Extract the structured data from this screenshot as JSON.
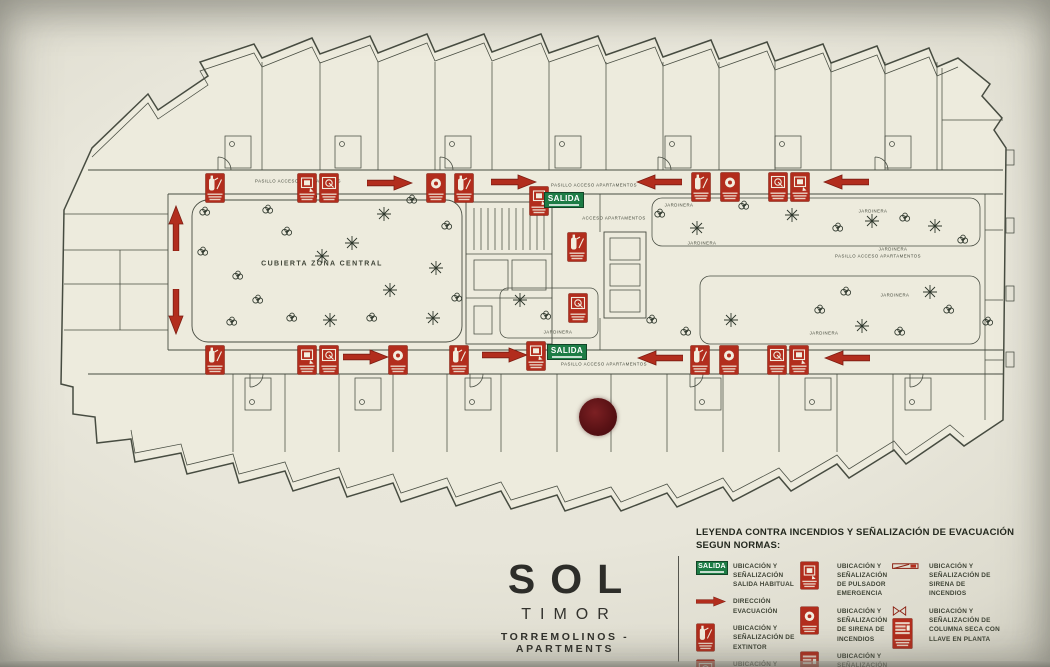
{
  "salida_text": "SALIDA",
  "title_block": {
    "brand": "SOL",
    "name": "TIMOR",
    "subtitle": "TORREMOLINOS - APARTMENTS"
  },
  "legend": {
    "title_line1": "LEYENDA CONTRA INCENDIOS Y SEÑALIZACIÓN DE EVACUACIÓN",
    "title_line2": "SEGUN NORMAS:",
    "columns": [
      {
        "items": [
          {
            "icon": "salida-sign",
            "label": "UBICACIÓN Y SEÑALIZACIÓN SALIDA HABITUAL"
          },
          {
            "icon": "evacuation-arrow",
            "label": "DIRECCIÓN EVACUACIÓN"
          },
          {
            "icon": "extintor",
            "label": "UBICACIÓN Y SEÑALIZACIÓN DE EXTINTOR"
          },
          {
            "icon": "boca-incendio",
            "label": "UBICACIÓN Y SEÑALIZACIÓN DE BOCA DE INCENDIO"
          }
        ]
      },
      {
        "items": [
          {
            "icon": "pulsador",
            "label": "UBICACIÓN Y SEÑALIZACIÓN DE PULSADOR EMERGENCIA"
          },
          {
            "icon": "sirena",
            "label": "UBICACIÓN Y SEÑALIZACIÓN DE SIRENA DE INCENDIOS"
          },
          {
            "icon": "columna-seca",
            "label": "UBICACIÓN Y SEÑALIZACIÓN DE COLUMNA SECA"
          }
        ]
      },
      {
        "items": [
          {
            "icon": "sirena-techo",
            "label": "UBICACIÓN Y SEÑALIZACIÓN DE SIRENA DE INCENDIOS"
          },
          {
            "icon": "columna-seca-llave",
            "label": "UBICACIÓN Y SEÑALIZACIÓN DE COLUMNA SECA CON LLAVE EN PLANTA"
          }
        ]
      }
    ]
  },
  "plan": {
    "labels": [
      {
        "text": "CUBIERTA ZONA CENTRAL",
        "x": 322,
        "y": 264,
        "size": 7
      },
      {
        "text": "PASILLO ACCESO APARTAMENTOS",
        "x": 298,
        "y": 181,
        "size": 4.3
      },
      {
        "text": "PASILLO ACCESO APARTAMENTOS",
        "x": 594,
        "y": 185,
        "size": 4.3
      },
      {
        "text": "PASILLO ACCESO APARTAMENTOS",
        "x": 878,
        "y": 256,
        "size": 4.3
      },
      {
        "text": "PASILLO ACCESO APARTAMENTOS",
        "x": 604,
        "y": 364,
        "size": 4.3
      },
      {
        "text": "ACCESO APARTAMENTOS",
        "x": 614,
        "y": 218,
        "size": 4.3
      },
      {
        "text": "JARDINERA",
        "x": 679,
        "y": 205,
        "size": 4.3
      },
      {
        "text": "JARDINERA",
        "x": 702,
        "y": 243,
        "size": 4.3
      },
      {
        "text": "JARDINERA",
        "x": 873,
        "y": 211,
        "size": 4.3
      },
      {
        "text": "JARDINERA",
        "x": 893,
        "y": 249,
        "size": 4.3
      },
      {
        "text": "JARDINERA",
        "x": 895,
        "y": 295,
        "size": 4.3
      },
      {
        "text": "JARDINERA",
        "x": 824,
        "y": 333,
        "size": 4.3
      },
      {
        "text": "JARDINERA",
        "x": 558,
        "y": 332,
        "size": 4.3
      }
    ],
    "markers": [
      {
        "type": "extintor",
        "x": 215,
        "y": 188
      },
      {
        "type": "pulsador",
        "x": 307,
        "y": 188
      },
      {
        "type": "boca-incendio",
        "x": 329,
        "y": 188
      },
      {
        "type": "arrow",
        "x": 390,
        "y": 183,
        "dir": "right"
      },
      {
        "type": "sirena",
        "x": 436,
        "y": 188
      },
      {
        "type": "extintor",
        "x": 464,
        "y": 188
      },
      {
        "type": "arrow",
        "x": 514,
        "y": 182,
        "dir": "right"
      },
      {
        "type": "pulsador",
        "x": 539,
        "y": 201
      },
      {
        "type": "salida-sign",
        "x": 564,
        "y": 200
      },
      {
        "type": "arrow",
        "x": 659,
        "y": 182,
        "dir": "left"
      },
      {
        "type": "extintor",
        "x": 701,
        "y": 187
      },
      {
        "type": "sirena",
        "x": 730,
        "y": 187
      },
      {
        "type": "boca-incendio",
        "x": 778,
        "y": 187
      },
      {
        "type": "pulsador",
        "x": 800,
        "y": 187
      },
      {
        "type": "arrow",
        "x": 846,
        "y": 182,
        "dir": "left"
      },
      {
        "type": "arrow",
        "x": 176,
        "y": 228,
        "dir": "up"
      },
      {
        "type": "arrow",
        "x": 176,
        "y": 312,
        "dir": "down"
      },
      {
        "type": "extintor",
        "x": 577,
        "y": 247
      },
      {
        "type": "boca-incendio",
        "x": 578,
        "y": 308
      },
      {
        "type": "extintor",
        "x": 215,
        "y": 360
      },
      {
        "type": "pulsador",
        "x": 307,
        "y": 360
      },
      {
        "type": "boca-incendio",
        "x": 329,
        "y": 360
      },
      {
        "type": "arrow",
        "x": 366,
        "y": 357,
        "dir": "right"
      },
      {
        "type": "sirena",
        "x": 398,
        "y": 360
      },
      {
        "type": "extintor",
        "x": 459,
        "y": 360
      },
      {
        "type": "arrow",
        "x": 505,
        "y": 355,
        "dir": "right"
      },
      {
        "type": "pulsador",
        "x": 536,
        "y": 356
      },
      {
        "type": "salida-sign",
        "x": 567,
        "y": 352
      },
      {
        "type": "arrow",
        "x": 660,
        "y": 358,
        "dir": "left"
      },
      {
        "type": "extintor",
        "x": 700,
        "y": 360
      },
      {
        "type": "sirena",
        "x": 729,
        "y": 360
      },
      {
        "type": "boca-incendio",
        "x": 777,
        "y": 360
      },
      {
        "type": "pulsador",
        "x": 799,
        "y": 360
      },
      {
        "type": "arrow",
        "x": 847,
        "y": 358,
        "dir": "left"
      }
    ],
    "plants": [
      [
        205,
        212,
        "b"
      ],
      [
        268,
        210,
        "b"
      ],
      [
        312,
        196,
        "b"
      ],
      [
        412,
        200,
        "b"
      ],
      [
        203,
        252,
        "b"
      ],
      [
        287,
        232,
        "b"
      ],
      [
        352,
        243,
        "p"
      ],
      [
        384,
        214,
        "p"
      ],
      [
        322,
        256,
        "p"
      ],
      [
        436,
        268,
        "p"
      ],
      [
        447,
        226,
        "b"
      ],
      [
        238,
        276,
        "b"
      ],
      [
        258,
        300,
        "b"
      ],
      [
        292,
        318,
        "b"
      ],
      [
        232,
        322,
        "b"
      ],
      [
        330,
        320,
        "p"
      ],
      [
        372,
        318,
        "b"
      ],
      [
        433,
        318,
        "p"
      ],
      [
        457,
        298,
        "b"
      ],
      [
        390,
        290,
        "p"
      ],
      [
        660,
        214,
        "b"
      ],
      [
        697,
        228,
        "p"
      ],
      [
        744,
        206,
        "b"
      ],
      [
        792,
        215,
        "p"
      ],
      [
        838,
        228,
        "b"
      ],
      [
        872,
        221,
        "p"
      ],
      [
        905,
        218,
        "b"
      ],
      [
        935,
        226,
        "p"
      ],
      [
        963,
        240,
        "b"
      ],
      [
        520,
        300,
        "p"
      ],
      [
        546,
        316,
        "b"
      ],
      [
        578,
        300,
        "b"
      ],
      [
        652,
        320,
        "b"
      ],
      [
        686,
        332,
        "b"
      ],
      [
        731,
        320,
        "p"
      ],
      [
        820,
        310,
        "b"
      ],
      [
        862,
        326,
        "p"
      ],
      [
        900,
        332,
        "b"
      ],
      [
        949,
        310,
        "b"
      ],
      [
        988,
        322,
        "b"
      ],
      [
        846,
        292,
        "b"
      ],
      [
        930,
        292,
        "p"
      ]
    ],
    "you_are_here": {
      "x": 598,
      "y": 417
    }
  },
  "colors": {
    "signal_red": "#b22d1d",
    "signal_red_dark": "#8c2012",
    "salida_green": "#1d7c45",
    "ink": "#474c41",
    "marker_dot": "#5a1215",
    "paper": "#e9e8de"
  }
}
